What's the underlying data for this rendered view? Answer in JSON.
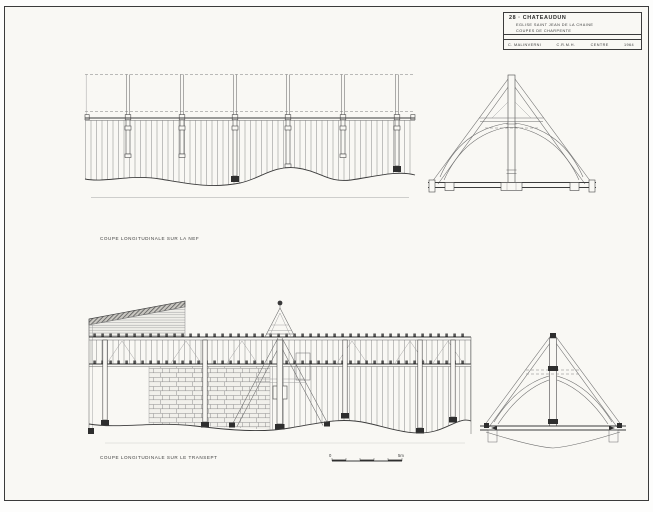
{
  "sheet": {
    "paper_color": "#f9f8f4",
    "ink_color": "#3b3b3b"
  },
  "title_block": {
    "line1": "28 · CHATEAUDUN",
    "line2": "EGLISE SAINT JEAN DE LA CHAINE",
    "line3": "COUPES DE CHARPENTE",
    "credit_author": "C. MALINVERNI",
    "credit_org": "C.R.M.H.",
    "credit_region": "CENTRE",
    "credit_year": "1964"
  },
  "captions": {
    "nave_section": "COUPE LONGITUDINALE SUR LA NEF",
    "transept_section": "COUPE LONGITUDINALE SUR LE TRANSEPT"
  },
  "scale_bar": {
    "zero_label": "0",
    "end_label": "5m"
  }
}
